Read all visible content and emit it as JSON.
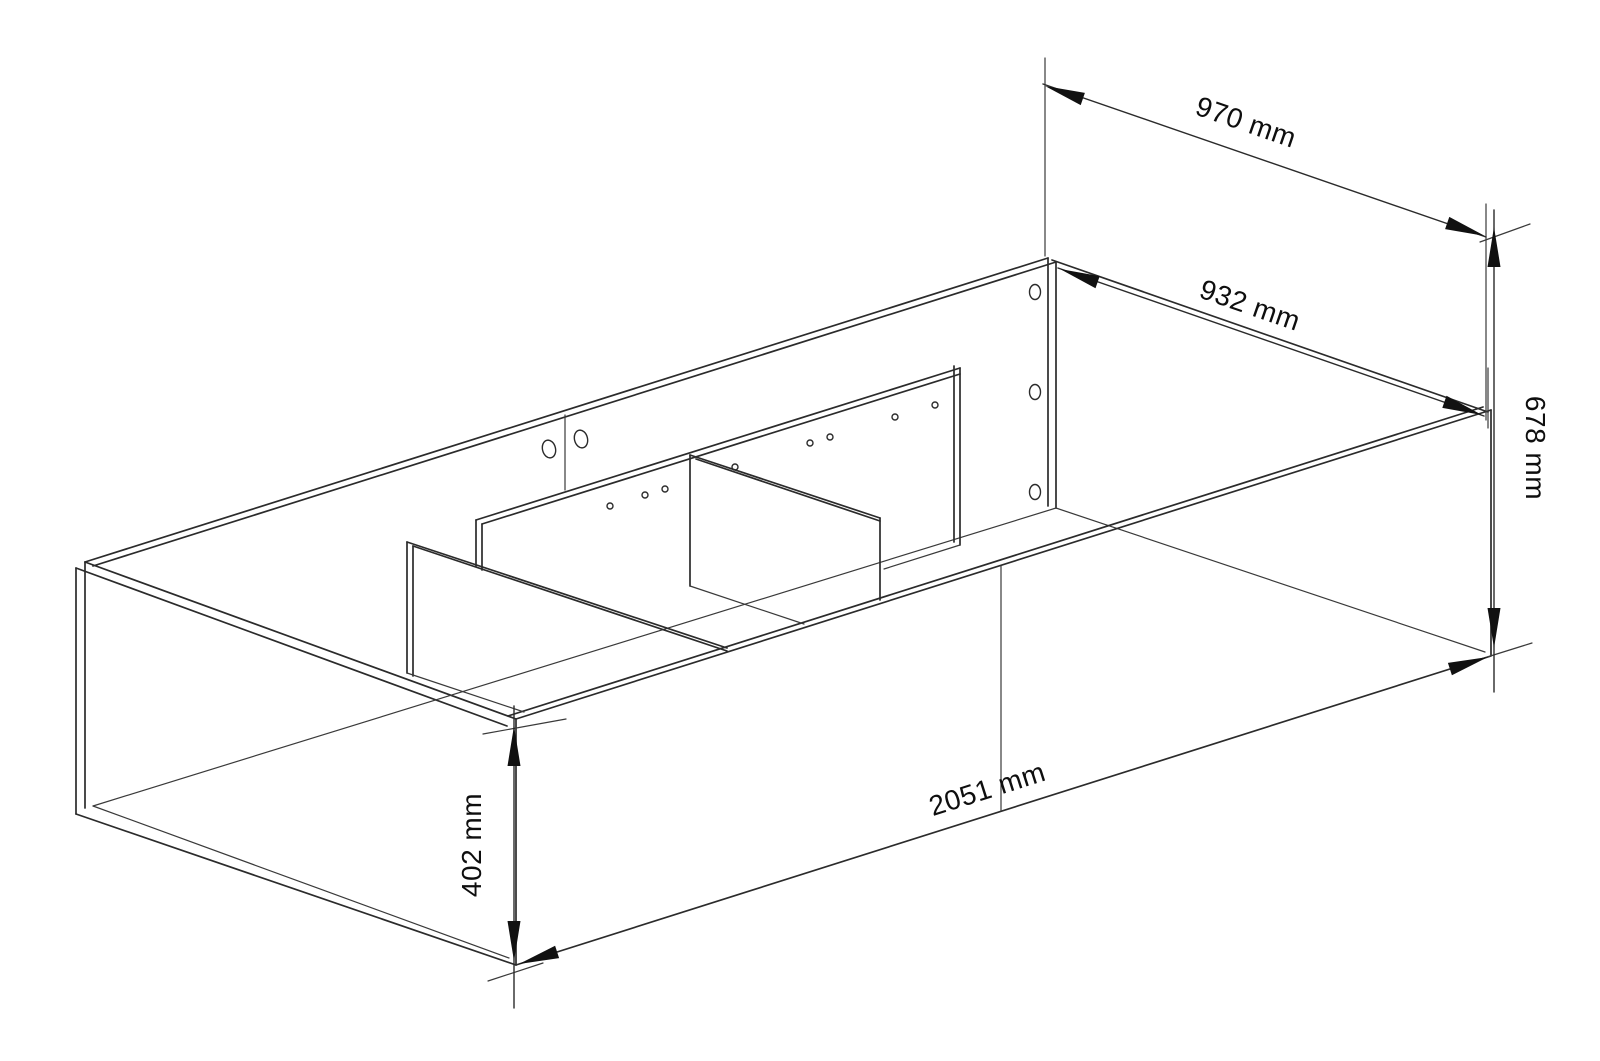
{
  "canvas": {
    "width": 1600,
    "height": 1061,
    "background_color": "#ffffff",
    "line_color": "#2b2b2b",
    "text_color": "#0e0e0e"
  },
  "drawing": {
    "kind": "isometric line drawing of furniture carcass with two cross dividers and a center rail",
    "units": "mm"
  },
  "dimensions": [
    {
      "id": "top-width",
      "label": "970 mm"
    },
    {
      "id": "inner-width",
      "label": "932 mm"
    },
    {
      "id": "height-back",
      "label": "678 mm"
    },
    {
      "id": "height-front",
      "label": "402 mm"
    },
    {
      "id": "length",
      "label": "2051 mm"
    }
  ]
}
